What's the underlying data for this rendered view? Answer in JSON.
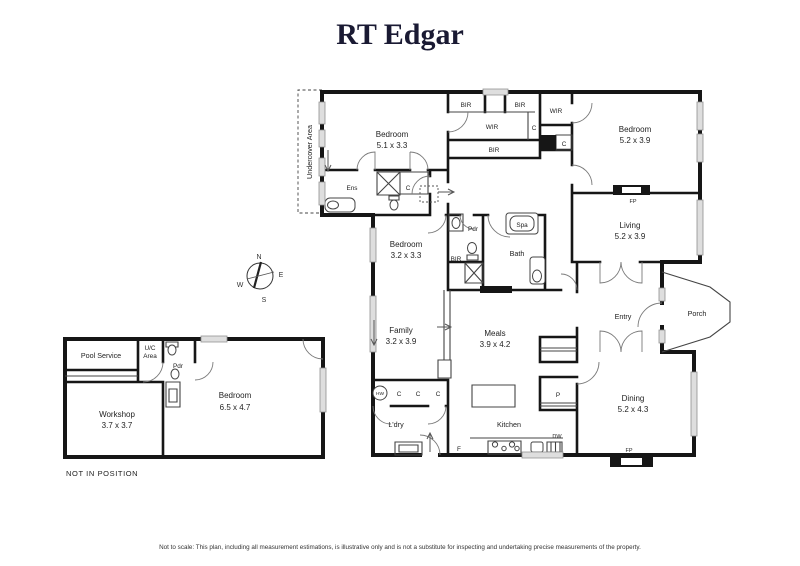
{
  "brand": {
    "name": "RT Edgar",
    "color": "#1a1a33"
  },
  "compass": {
    "n": "N",
    "e": "E",
    "s": "S",
    "w": "W"
  },
  "main_house": {
    "undercover": "Undercover Area",
    "bedroom1": {
      "name": "Bedroom",
      "dims": "5.1 x 3.3"
    },
    "bedroom2": {
      "name": "Bedroom",
      "dims": "5.2 x 3.9"
    },
    "bedroom3": {
      "name": "Bedroom",
      "dims": "3.2 x 3.3"
    },
    "living": {
      "name": "Living",
      "dims": "5.2 x 3.9"
    },
    "family": {
      "name": "Family",
      "dims": "3.2 x 3.9"
    },
    "meals": {
      "name": "Meals",
      "dims": "3.9 x 4.2"
    },
    "dining": {
      "name": "Dining",
      "dims": "5.2 x 4.3"
    },
    "kitchen": "Kitchen",
    "entry": "Entry",
    "porch": "Porch",
    "bath": "Bath",
    "laundry": "L'dry",
    "ensuite": "Ens",
    "powder": "Pdr",
    "spa": "Spa"
  },
  "fixtures": {
    "bir": "BIR",
    "wir": "WIR",
    "cupboard": "C",
    "hot_water": "HW",
    "pantry": "P",
    "fridge": "F",
    "dishwasher": "DW",
    "fireplace": "FP"
  },
  "outbuilding": {
    "pool_service": "Pool Service",
    "uc_line1": "U/C",
    "uc_line2": "Area",
    "powder": "Pdr",
    "workshop": {
      "name": "Workshop",
      "dims": "3.7 x 3.7"
    },
    "bedroom": {
      "name": "Bedroom",
      "dims": "6.5 x 4.7"
    },
    "note": "NOT IN POSITION"
  },
  "footer": {
    "disclaimer": "Not to scale: This plan, including all measurement estimations, is illustrative only and is not a substitute for inspecting and undertaking precise measurements of the property."
  }
}
